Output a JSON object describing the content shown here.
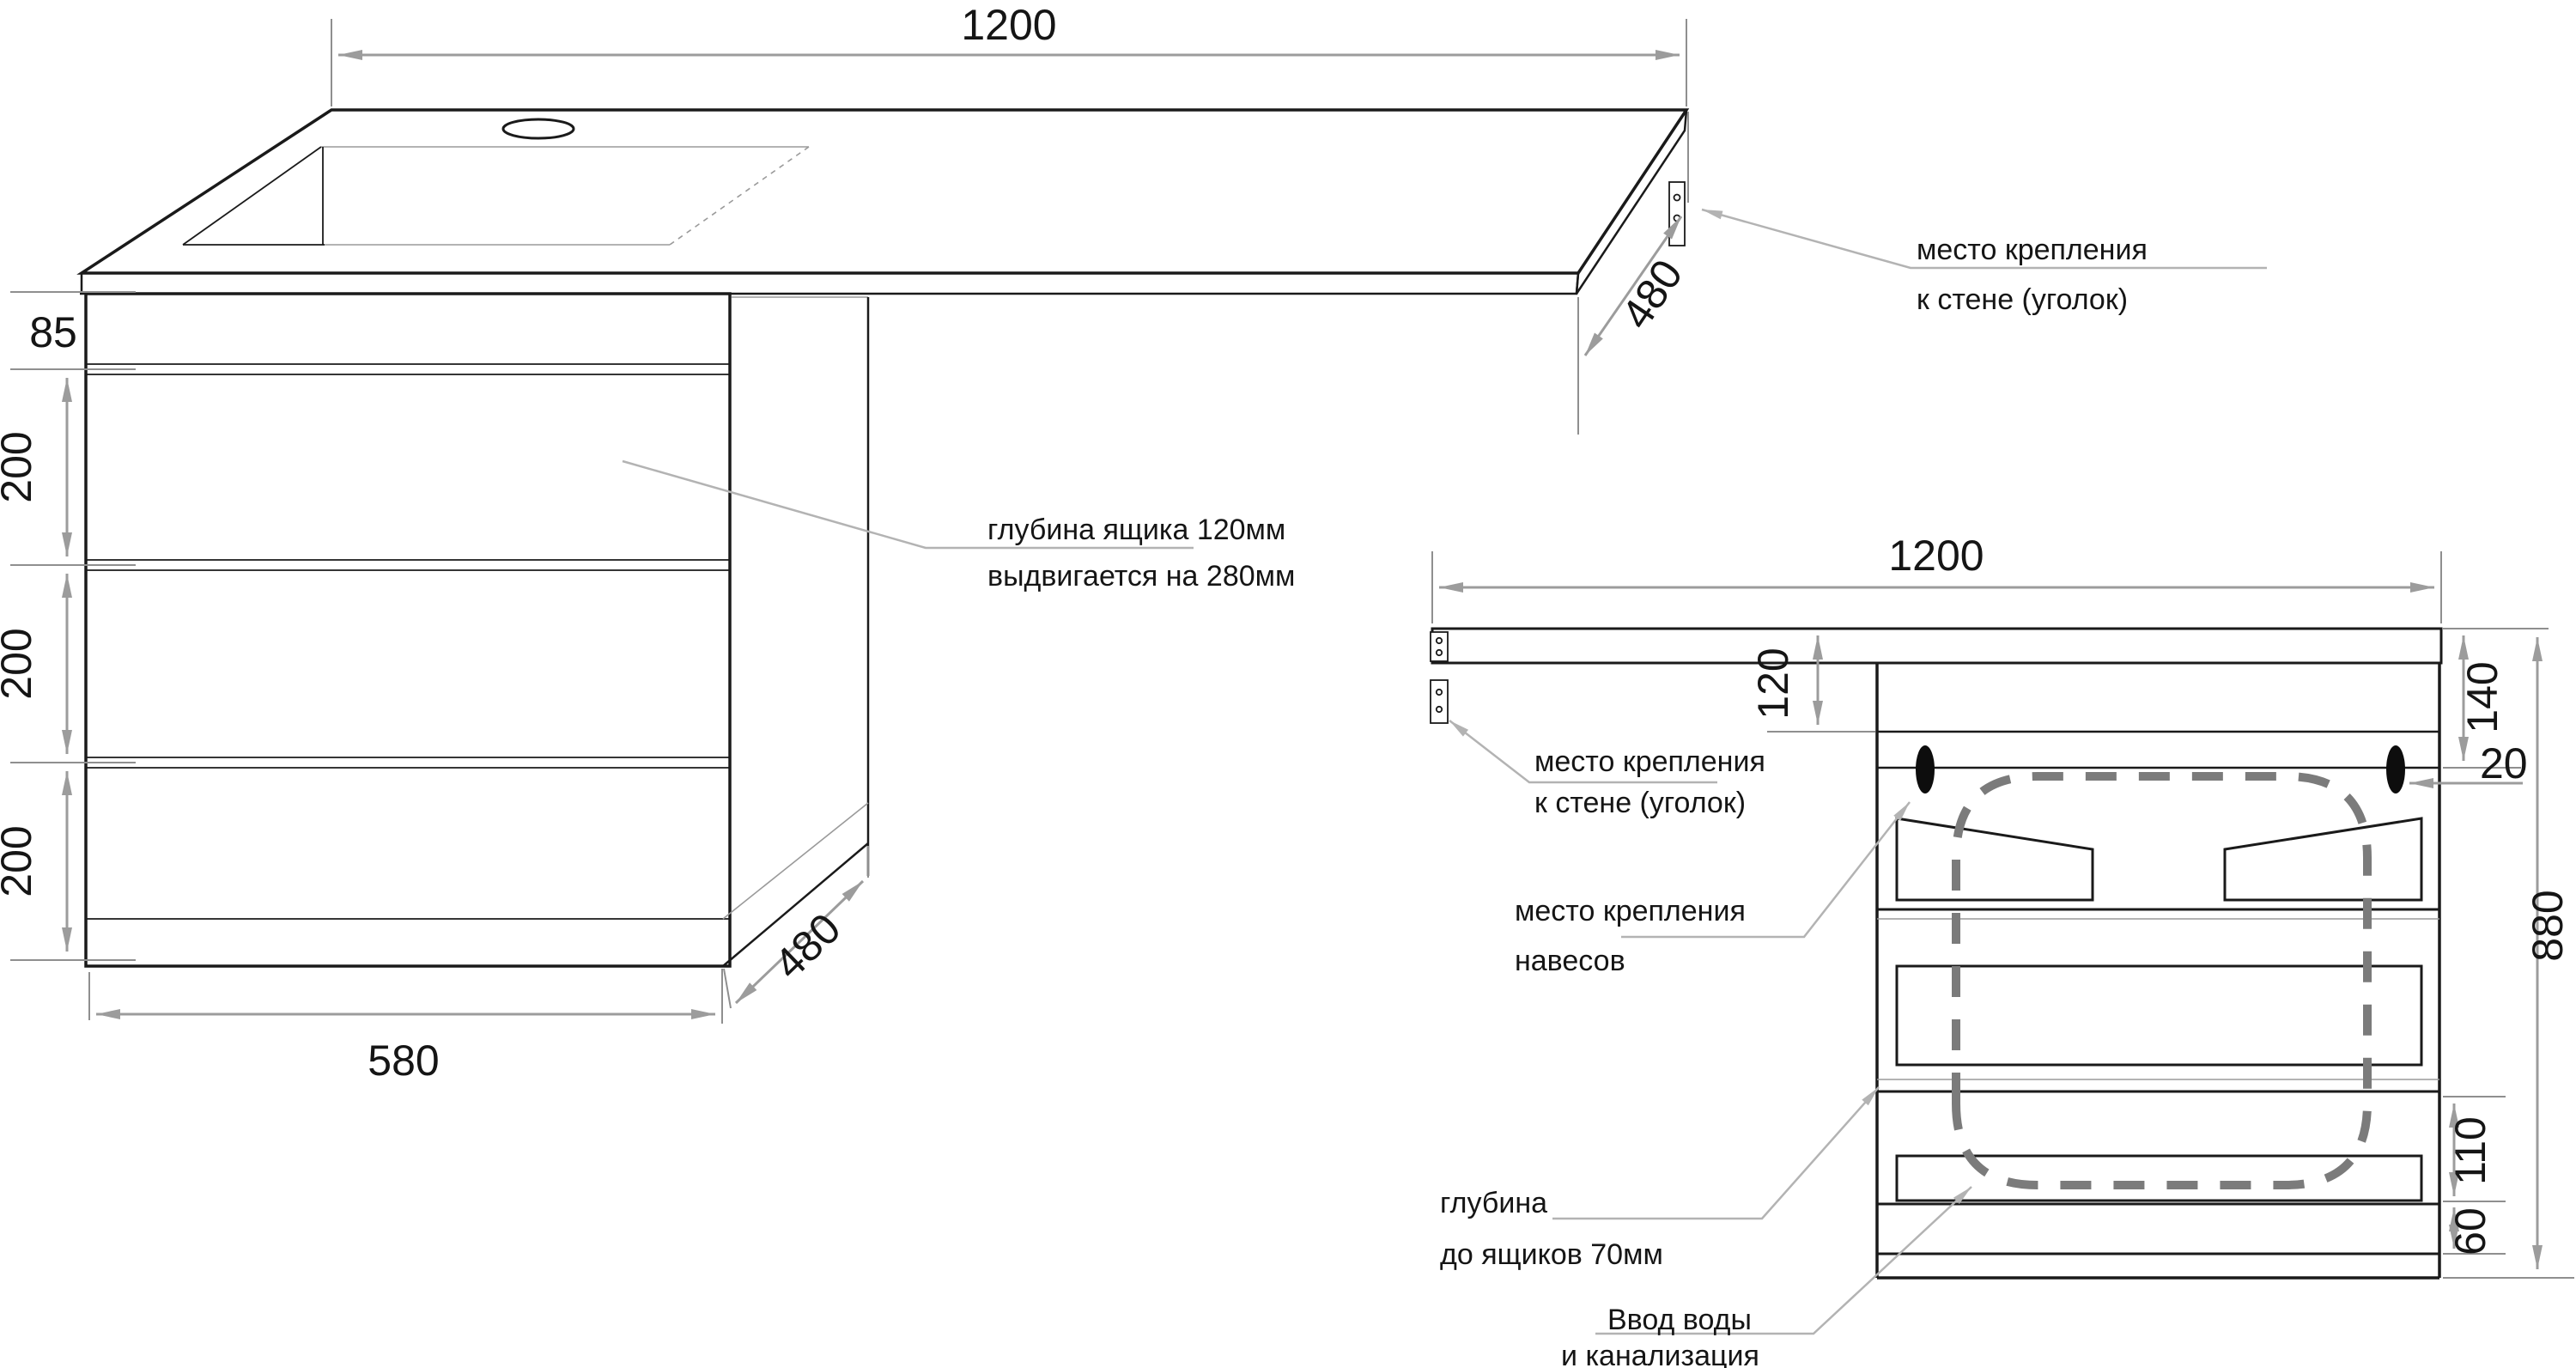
{
  "drawing_title": "vanity-cabinet-dimension-drawing",
  "colors": {
    "line": "#1a1a1a",
    "dimension": "#9c9c9c",
    "leader": "#b3b3b3",
    "pipe_dash": "#7b7b7b",
    "background": "#ffffff"
  },
  "lv": {
    "width": "1200",
    "apron": "85",
    "d1": "200",
    "d2": "200",
    "d3": "200",
    "base_width": "580",
    "depth_top": "480",
    "depth_side": "480",
    "wall1": "место крепления",
    "wall2": "к стене (уголок)",
    "drawer1": "глубина ящика 120мм",
    "drawer2": "выдвигается на 280мм"
  },
  "fv": {
    "width": "1200",
    "recess": "120",
    "top": "140",
    "gap": "20",
    "height": "880",
    "drawer_zone": "110",
    "plinth": "60",
    "wall1": "место крепления",
    "wall2": "к стене (уголок)",
    "hang1": "место крепления",
    "hang2": "навесов",
    "depth1": "глубина",
    "depth2": "до ящиков 70мм",
    "water1": "Ввод воды",
    "water2": "и канализация"
  }
}
